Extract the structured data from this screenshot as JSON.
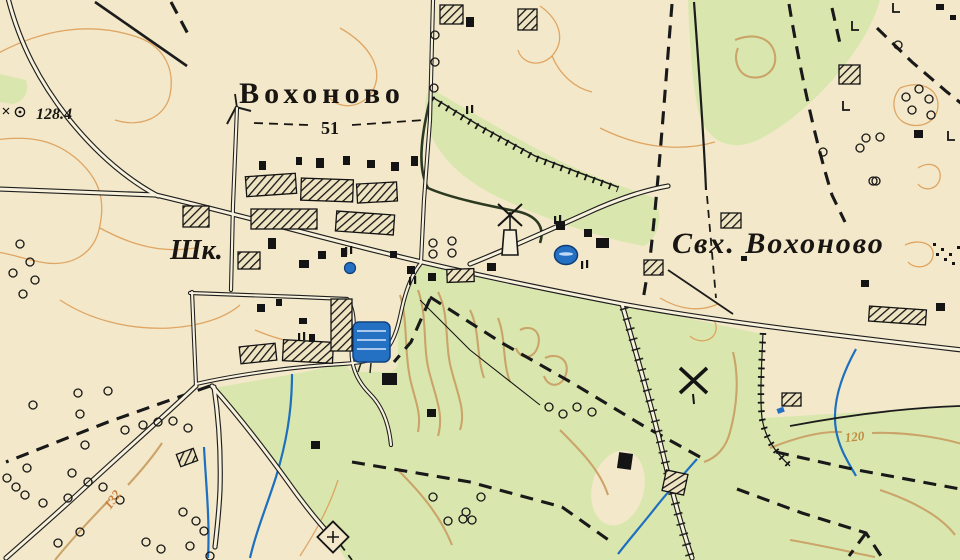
{
  "meta": {
    "description": "Old Soviet topographic map sheet fragment, village Vokhonovo",
    "language": "Russian"
  },
  "labels": {
    "village_name": "Вохоново",
    "village_number": "51",
    "sovkhoz_label": "Свх. Вохоново",
    "school_abbr": "Шк.",
    "elevation_point": "128.4",
    "contour_left": "132",
    "contour_right": "120"
  },
  "colors": {
    "paper": "#f3e8c9",
    "meadow_green": "#d9e7ae",
    "contour_orange": "#dd9d58",
    "contour_tan": "#c9a065",
    "ink_black": "#1a1a1a",
    "water_blue": "#2470c2",
    "road_fill": "#f8f2dd"
  },
  "symbols": {
    "windmill_icon": [
      [
        509,
        232
      ],
      [
        693,
        380
      ]
    ],
    "chapel_icon": [
      333,
      537
    ],
    "pond_icon": [
      371,
      341
    ],
    "well_icon": [
      [
        566,
        255
      ],
      [
        350,
        268
      ]
    ],
    "elevation_marker_icon": [
      20,
      112
    ]
  },
  "features": {
    "tree_circles": [
      [
        435,
        35
      ],
      [
        435,
        62
      ],
      [
        434,
        88
      ],
      [
        433,
        243
      ],
      [
        452,
        241
      ],
      [
        433,
        254
      ],
      [
        452,
        253
      ],
      [
        906,
        97
      ],
      [
        919,
        89
      ],
      [
        929,
        99
      ],
      [
        912,
        110
      ],
      [
        931,
        115
      ],
      [
        866,
        138
      ],
      [
        880,
        137
      ],
      [
        860,
        148
      ],
      [
        876,
        181
      ],
      [
        898,
        45
      ],
      [
        823,
        152
      ],
      [
        873,
        181
      ],
      [
        20,
        244
      ],
      [
        30,
        262
      ],
      [
        13,
        273
      ],
      [
        35,
        280
      ],
      [
        23,
        294
      ],
      [
        33,
        405
      ],
      [
        78,
        393
      ],
      [
        80,
        414
      ],
      [
        108,
        391
      ],
      [
        125,
        430
      ],
      [
        143,
        425
      ],
      [
        158,
        422
      ],
      [
        173,
        421
      ],
      [
        188,
        428
      ],
      [
        85,
        445
      ],
      [
        27,
        468
      ],
      [
        7,
        478
      ],
      [
        72,
        473
      ],
      [
        16,
        487
      ],
      [
        25,
        495
      ],
      [
        43,
        503
      ],
      [
        68,
        498
      ],
      [
        88,
        482
      ],
      [
        103,
        487
      ],
      [
        80,
        532
      ],
      [
        58,
        543
      ],
      [
        120,
        500
      ],
      [
        183,
        512
      ],
      [
        196,
        521
      ],
      [
        204,
        531
      ],
      [
        190,
        546
      ],
      [
        161,
        549
      ],
      [
        146,
        542
      ],
      [
        210,
        556
      ],
      [
        433,
        497
      ],
      [
        448,
        521
      ],
      [
        463,
        519
      ],
      [
        472,
        520
      ],
      [
        481,
        497
      ],
      [
        466,
        512
      ],
      [
        549,
        407
      ],
      [
        563,
        414
      ],
      [
        577,
        407
      ],
      [
        592,
        412
      ]
    ],
    "buildings_solid": [
      [
        316,
        158,
        8,
        10,
        0
      ],
      [
        343,
        156,
        7,
        9,
        0
      ],
      [
        367,
        160,
        8,
        8,
        0
      ],
      [
        296,
        157,
        6,
        8,
        0
      ],
      [
        259,
        161,
        7,
        9,
        0
      ],
      [
        391,
        162,
        8,
        9,
        0
      ],
      [
        411,
        156,
        7,
        10,
        0
      ],
      [
        268,
        238,
        8,
        11,
        0
      ],
      [
        299,
        260,
        10,
        8,
        0
      ],
      [
        318,
        251,
        8,
        8,
        0
      ],
      [
        341,
        248,
        6,
        9,
        0
      ],
      [
        390,
        251,
        7,
        7,
        0
      ],
      [
        407,
        266,
        8,
        8,
        0
      ],
      [
        428,
        273,
        8,
        8,
        0
      ],
      [
        257,
        304,
        8,
        8,
        0
      ],
      [
        276,
        299,
        6,
        7,
        0
      ],
      [
        299,
        318,
        8,
        6,
        0
      ],
      [
        309,
        334,
        6,
        8,
        0
      ],
      [
        382,
        373,
        15,
        12,
        0
      ],
      [
        427,
        409,
        9,
        8,
        0
      ],
      [
        311,
        441,
        9,
        8,
        0
      ],
      [
        466,
        17,
        8,
        10,
        0
      ],
      [
        556,
        221,
        9,
        9,
        0
      ],
      [
        584,
        229,
        8,
        8,
        0
      ],
      [
        596,
        238,
        13,
        10,
        0
      ],
      [
        487,
        263,
        9,
        8,
        0
      ],
      [
        741,
        256,
        6,
        5,
        0
      ],
      [
        861,
        280,
        8,
        7,
        0
      ],
      [
        936,
        303,
        9,
        8,
        0
      ],
      [
        914,
        130,
        9,
        8,
        0
      ],
      [
        618,
        453,
        14,
        16,
        8
      ],
      [
        936,
        4,
        8,
        6,
        0
      ],
      [
        950,
        15,
        6,
        5,
        0
      ]
    ],
    "buildings_hatched": [
      [
        246,
        175,
        50,
        20,
        -4
      ],
      [
        301,
        179,
        52,
        22,
        2
      ],
      [
        357,
        183,
        40,
        19,
        -3
      ],
      [
        251,
        209,
        66,
        20,
        0
      ],
      [
        336,
        213,
        58,
        20,
        4
      ],
      [
        183,
        206,
        26,
        21,
        0
      ],
      [
        238,
        252,
        22,
        17,
        0
      ],
      [
        240,
        345,
        36,
        17,
        -6
      ],
      [
        283,
        341,
        50,
        21,
        3
      ],
      [
        331,
        299,
        21,
        52,
        0
      ],
      [
        447,
        269,
        27,
        13,
        -2
      ],
      [
        440,
        5,
        23,
        19,
        0
      ],
      [
        518,
        9,
        19,
        21,
        0
      ],
      [
        839,
        65,
        21,
        19,
        0
      ],
      [
        721,
        213,
        20,
        15,
        0
      ],
      [
        644,
        260,
        19,
        15,
        0
      ],
      [
        869,
        308,
        57,
        15,
        4
      ],
      [
        782,
        393,
        19,
        13,
        0
      ],
      [
        178,
        451,
        18,
        13,
        -20
      ],
      [
        664,
        472,
        22,
        21,
        12
      ]
    ],
    "paired_posts": [
      [
        345,
        247
      ],
      [
        409,
        277
      ],
      [
        581,
        261
      ],
      [
        554,
        216
      ],
      [
        298,
        333
      ],
      [
        466,
        106
      ]
    ],
    "l_symbols": [
      [
        852,
        30
      ],
      [
        843,
        110
      ],
      [
        948,
        140
      ],
      [
        893,
        12
      ]
    ],
    "dot_marks": [
      [
        933,
        243
      ],
      [
        941,
        248
      ],
      [
        949,
        253
      ],
      [
        936,
        253
      ],
      [
        944,
        258
      ],
      [
        952,
        262
      ],
      [
        957,
        246
      ]
    ]
  }
}
